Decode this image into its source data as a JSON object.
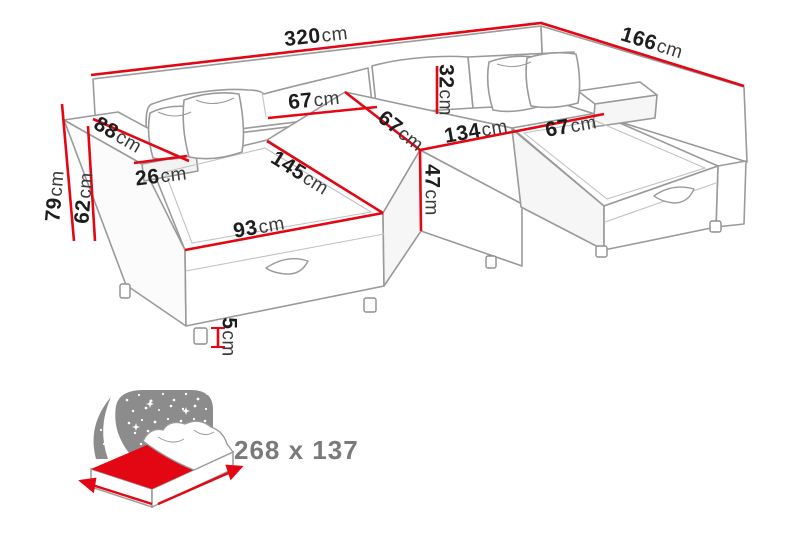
{
  "dims": {
    "d320": {
      "value": "320",
      "unit": "cm"
    },
    "d166": {
      "value": "166",
      "unit": "cm"
    },
    "d79": {
      "value": "79",
      "unit": "cm"
    },
    "d62": {
      "value": "62",
      "unit": "cm"
    },
    "d88": {
      "value": "88",
      "unit": "cm"
    },
    "d26": {
      "value": "26",
      "unit": "cm"
    },
    "d67_backrest": {
      "value": "67",
      "unit": "cm"
    },
    "d67_middle": {
      "value": "67",
      "unit": "cm"
    },
    "d32": {
      "value": "32",
      "unit": "cm"
    },
    "d134": {
      "value": "134",
      "unit": "cm"
    },
    "d67_right": {
      "value": "67",
      "unit": "cm"
    },
    "d47": {
      "value": "47",
      "unit": "cm"
    },
    "d145": {
      "value": "145",
      "unit": "cm"
    },
    "d93": {
      "value": "93",
      "unit": "cm"
    },
    "d5": {
      "value": "5",
      "unit": "cm"
    }
  },
  "bed_icon": {
    "size_label": "268 x 137"
  },
  "colors": {
    "dimension_red": "#e30613",
    "outline_gray": "#9a9a9a",
    "label_dark": "#1d1d1d",
    "icon_gray": "#8c8c8c",
    "bed_text_gray": "#7a7a7a"
  }
}
